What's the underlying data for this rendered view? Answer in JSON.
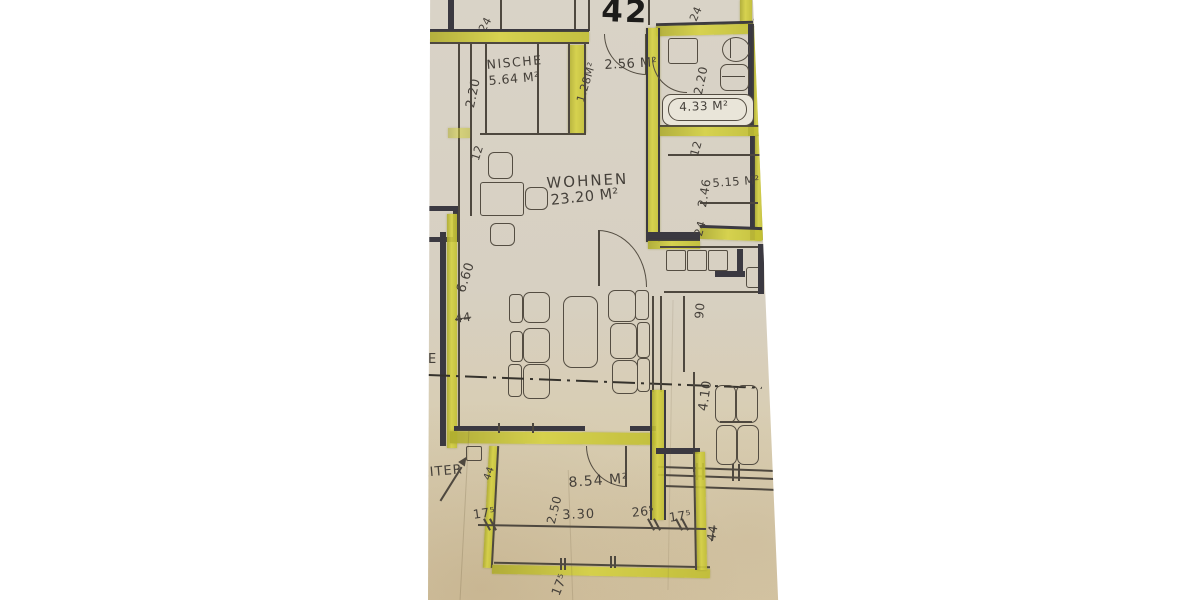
{
  "plan": {
    "apartment_number": "42",
    "rooms": {
      "nische_name": "NISCHE",
      "nische_area": "5.64 M²",
      "entry_area": "2.56 M²",
      "wardrobe_area": "1.28M²",
      "bath_area": "4.33 M²",
      "side_room_area": "5.15 M²",
      "living_name": "WOHNEN",
      "living_area": "23.20 M²",
      "balcony_area": "8.54 M²"
    },
    "dims": {
      "d24_top_left": "24",
      "d24_bath_top": "24",
      "d24_top_right": "24",
      "d220_nische": "2.20",
      "d12_left": "12",
      "d220_bath": "2.20",
      "d12_below_bath": "12",
      "d246_side": "2.46",
      "d24_side": "24",
      "d660_living": "6.60",
      "d44_living": "44",
      "d90_kitchen": "90",
      "d410_room": "4.10",
      "d250_balcony": "2.50",
      "d330_balcony": "3.30",
      "d175_left": "17⁵",
      "d265_right": "26⁵",
      "d175_right": "17⁵",
      "d175_bottom": "17⁵",
      "d44_bottom": "44",
      "d44_ladder": "44"
    },
    "notes": {
      "ladder_fragment": "EITER",
      "edge_letter": "E"
    },
    "colors": {
      "highlight_yellow": "#d0cc3c",
      "paper": "#d7d0c2",
      "pencil": "#4e483f",
      "dark_wall": "#3b3941"
    }
  }
}
